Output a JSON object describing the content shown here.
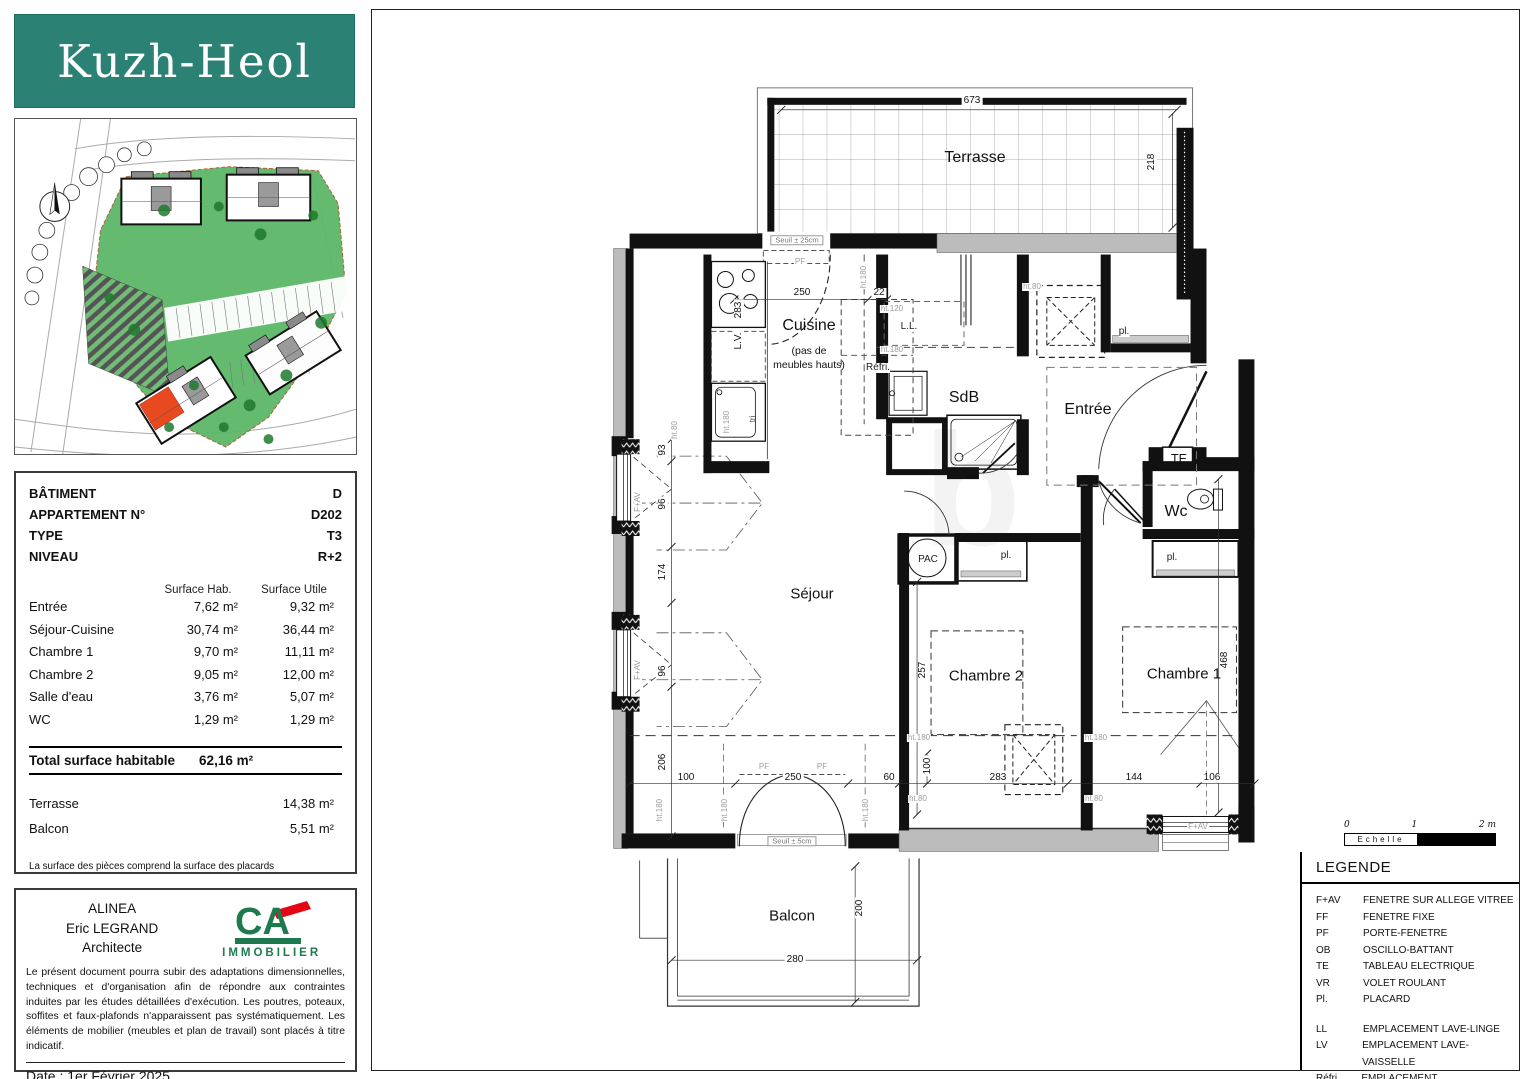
{
  "logo": {
    "title": "Kuzh-Heol",
    "bg_color": "#2a8174"
  },
  "info_panel": {
    "fields": [
      {
        "label": "BÂTIMENT",
        "value": "D"
      },
      {
        "label": "APPARTEMENT N°",
        "value": "D202"
      },
      {
        "label": "TYPE",
        "value": "T3"
      },
      {
        "label": "NIVEAU",
        "value": "R+2"
      }
    ],
    "surface_table": {
      "headers": [
        "Surface Hab.",
        "Surface Utile"
      ],
      "rows": [
        {
          "room": "Entrée",
          "hab": "7,62 m²",
          "utile": "9,32 m²"
        },
        {
          "room": "Séjour-Cuisine",
          "hab": "30,74 m²",
          "utile": "36,44 m²"
        },
        {
          "room": "Chambre 1",
          "hab": "9,70 m²",
          "utile": "11,11 m²"
        },
        {
          "room": "Chambre 2",
          "hab": "9,05 m²",
          "utile": "12,00 m²"
        },
        {
          "room": "Salle d'eau",
          "hab": "3,76 m²",
          "utile": "5,07 m²"
        },
        {
          "room": "WC",
          "hab": "1,29 m²",
          "utile": "1,29 m²"
        }
      ]
    },
    "total": {
      "label": "Total surface habitable",
      "value": "62,16 m²"
    },
    "outdoor_rows": [
      {
        "label": "Terrasse",
        "value": "14,38 m²"
      },
      {
        "label": "Balcon",
        "value": "5,51 m²"
      }
    ],
    "note": "La surface des pièces comprend la surface des placards"
  },
  "architect_panel": {
    "firm": "ALINEA",
    "name": "Eric LEGRAND",
    "role": "Architecte",
    "brand": {
      "letters": "CA",
      "sub": "IMMOBILIER",
      "green": "#1d7a4f",
      "red": "#e30613"
    },
    "disclaimer": "Le présent document pourra subir des adaptations dimensionnelles, techniques et d'organisation afin de répondre aux contraintes induites par les études détaillées d'exécution. Les poutres, poteaux, soffites et faux-plafonds n'apparaissent pas systématiquement. Les éléments de mobilier (meubles et plan de travail) sont placés à titre indicatif.",
    "date": "Date : 1er Février 2025"
  },
  "plan": {
    "watermark": "b",
    "scalebar": {
      "ticks": [
        "0",
        "1",
        "2 m"
      ],
      "label": "Echelle"
    },
    "labels": [
      {
        "t": "Terrasse",
        "x": 603,
        "y": 148,
        "c": "room"
      },
      {
        "t": "673",
        "x": 600,
        "y": 91,
        "c": "dim"
      },
      {
        "t": "218",
        "x": 780,
        "y": 152,
        "c": "dim",
        "v": true
      },
      {
        "t": "Seuil ± 25cm",
        "x": 425,
        "y": 230,
        "c": "seuil"
      },
      {
        "t": "PF",
        "x": 428,
        "y": 252,
        "c": "ann"
      },
      {
        "t": "250",
        "x": 430,
        "y": 283,
        "c": "dim"
      },
      {
        "t": "22",
        "x": 507,
        "y": 283,
        "c": "dim"
      },
      {
        "t": "Cuisine",
        "x": 437,
        "y": 316,
        "c": "room"
      },
      {
        "t": "(pas de",
        "x": 437,
        "y": 341,
        "c": "rs"
      },
      {
        "t": "meubles hauts)",
        "x": 437,
        "y": 355,
        "c": "rs"
      },
      {
        "t": "283",
        "x": 367,
        "y": 300,
        "c": "dim",
        "v": true
      },
      {
        "t": "L.V.",
        "x": 367,
        "y": 331,
        "c": "dim",
        "v": true
      },
      {
        "t": "tri",
        "x": 381,
        "y": 409,
        "c": "tiny",
        "v": true
      },
      {
        "t": "ht.180",
        "x": 492,
        "y": 267,
        "c": "ann",
        "v": true
      },
      {
        "t": "ht.120",
        "x": 520,
        "y": 299,
        "c": "ann"
      },
      {
        "t": "L.L.",
        "x": 537,
        "y": 317,
        "c": "tag"
      },
      {
        "t": "ht.180",
        "x": 520,
        "y": 340,
        "c": "ann"
      },
      {
        "t": "Réfri.",
        "x": 506,
        "y": 358,
        "c": "tag"
      },
      {
        "t": "SdB",
        "x": 592,
        "y": 388,
        "c": "room"
      },
      {
        "t": "ht.80",
        "x": 660,
        "y": 277,
        "c": "ann"
      },
      {
        "t": "pl.",
        "x": 752,
        "y": 322,
        "c": "tag"
      },
      {
        "t": "Entrée",
        "x": 716,
        "y": 400,
        "c": "room"
      },
      {
        "t": "TE",
        "x": 807,
        "y": 449,
        "c": "te"
      },
      {
        "t": "Wc",
        "x": 804,
        "y": 502,
        "c": "room"
      },
      {
        "t": "pl.",
        "x": 800,
        "y": 548,
        "c": "tag"
      },
      {
        "t": "PAC",
        "x": 556,
        "y": 550,
        "c": "tag"
      },
      {
        "t": "pl.",
        "x": 634,
        "y": 546,
        "c": "tag"
      },
      {
        "t": "Séjour",
        "x": 440,
        "y": 584,
        "c": "room2"
      },
      {
        "t": "Chambre 2",
        "x": 614,
        "y": 666,
        "c": "room2"
      },
      {
        "t": "257",
        "x": 551,
        "y": 660,
        "c": "dim",
        "v": true
      },
      {
        "t": "Chambre 1",
        "x": 812,
        "y": 664,
        "c": "room2"
      },
      {
        "t": "468",
        "x": 853,
        "y": 650,
        "c": "dim",
        "v": true
      },
      {
        "t": "ht.80",
        "x": 303,
        "y": 420,
        "c": "ann",
        "v": true
      },
      {
        "t": "93",
        "x": 291,
        "y": 440,
        "c": "dim",
        "v": true
      },
      {
        "t": "ht.180",
        "x": 355,
        "y": 412,
        "c": "ann",
        "v": true
      },
      {
        "t": "F+AV",
        "x": 266,
        "y": 492,
        "c": "ann",
        "v": true
      },
      {
        "t": "96",
        "x": 291,
        "y": 494,
        "c": "dim",
        "v": true
      },
      {
        "t": "174",
        "x": 291,
        "y": 562,
        "c": "dim",
        "v": true
      },
      {
        "t": "F+AV",
        "x": 266,
        "y": 660,
        "c": "ann",
        "v": true
      },
      {
        "t": "96",
        "x": 291,
        "y": 661,
        "c": "dim",
        "v": true
      },
      {
        "t": "206",
        "x": 291,
        "y": 752,
        "c": "dim",
        "v": true
      },
      {
        "t": "ht.180",
        "x": 288,
        "y": 800,
        "c": "ann",
        "v": true
      },
      {
        "t": "ht.180",
        "x": 353,
        "y": 800,
        "c": "ann",
        "v": true
      },
      {
        "t": "ht.180",
        "x": 494,
        "y": 800,
        "c": "ann",
        "v": true
      },
      {
        "t": "100",
        "x": 314,
        "y": 768,
        "c": "dim"
      },
      {
        "t": "250",
        "x": 421,
        "y": 768,
        "c": "dim"
      },
      {
        "t": "PF",
        "x": 392,
        "y": 757,
        "c": "ann"
      },
      {
        "t": "PF",
        "x": 450,
        "y": 757,
        "c": "ann"
      },
      {
        "t": "60",
        "x": 517,
        "y": 768,
        "c": "dim"
      },
      {
        "t": "100",
        "x": 556,
        "y": 756,
        "c": "dim",
        "v": true
      },
      {
        "t": "283",
        "x": 626,
        "y": 768,
        "c": "dim"
      },
      {
        "t": "144",
        "x": 762,
        "y": 768,
        "c": "dim"
      },
      {
        "t": "106",
        "x": 840,
        "y": 768,
        "c": "dim"
      },
      {
        "t": "ht.180",
        "x": 547,
        "y": 728,
        "c": "ann"
      },
      {
        "t": "ht.180",
        "x": 724,
        "y": 728,
        "c": "ann"
      },
      {
        "t": "ht.80",
        "x": 546,
        "y": 789,
        "c": "ann"
      },
      {
        "t": "ht.80",
        "x": 722,
        "y": 789,
        "c": "ann"
      },
      {
        "t": "F+AV",
        "x": 826,
        "y": 817,
        "c": "ann"
      },
      {
        "t": "Seuil ± 5cm",
        "x": 420,
        "y": 831,
        "c": "seuil"
      },
      {
        "t": "Balcon",
        "x": 420,
        "y": 906,
        "c": "room2"
      },
      {
        "t": "200",
        "x": 488,
        "y": 898,
        "c": "dim",
        "v": true
      },
      {
        "t": "280",
        "x": 423,
        "y": 950,
        "c": "dim"
      }
    ]
  },
  "legend": {
    "title": "LEGENDE",
    "groups": [
      [
        {
          "abbr": "F+AV",
          "label": "FENETRE SUR ALLEGE VITREE"
        },
        {
          "abbr": "FF",
          "label": "FENETRE FIXE"
        },
        {
          "abbr": "PF",
          "label": "PORTE-FENETRE"
        },
        {
          "abbr": "OB",
          "label": "OSCILLO-BATTANT"
        },
        {
          "abbr": "TE",
          "label": "TABLEAU ELECTRIQUE"
        },
        {
          "abbr": "VR",
          "label": "VOLET ROULANT"
        },
        {
          "abbr": "Pl.",
          "label": "PLACARD"
        }
      ],
      [
        {
          "abbr": "LL",
          "label": "EMPLACEMENT LAVE-LINGE"
        },
        {
          "abbr": "LV",
          "label": "EMPLACEMENT LAVE-VAISSELLE"
        },
        {
          "abbr": "Réfri.",
          "label": "EMPLACEMENT REFRIGERATEUR"
        },
        {
          "abbr": "",
          "icon": "hatch",
          "label": "FAUX-PLAFOND OU SOFFITE"
        }
      ]
    ]
  }
}
